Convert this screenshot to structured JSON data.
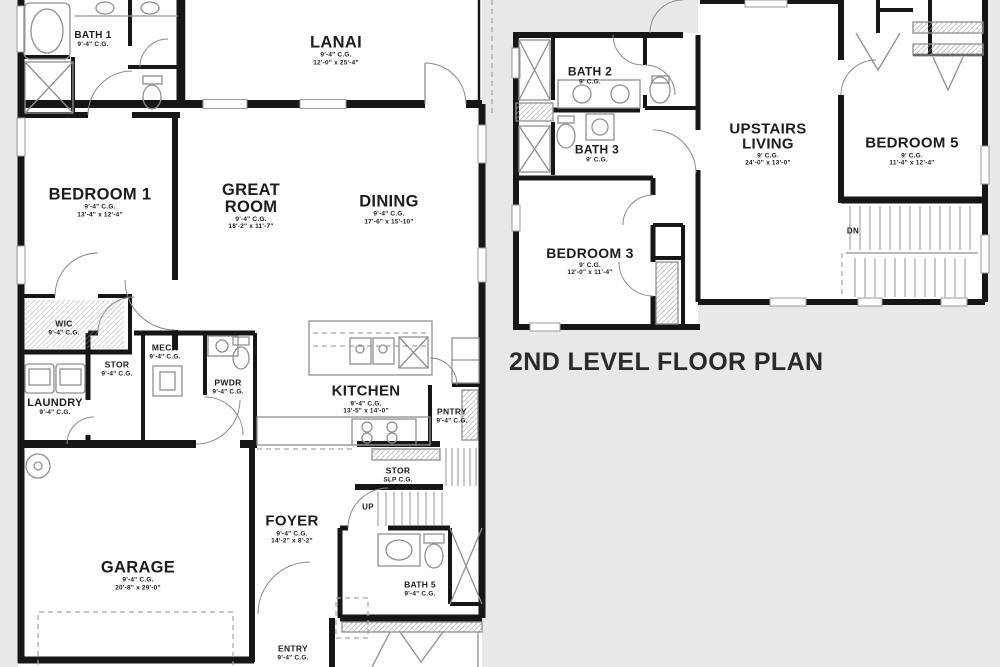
{
  "colors": {
    "background": "#e8e8e8",
    "plan": "#ffffff",
    "wall": "#161616",
    "fixture": "#8f8f8f",
    "text": "#1c1c1c"
  },
  "caption": "2ND LEVEL FLOOR PLAN",
  "first_level": {
    "rooms": {
      "bath_1": {
        "name": "BATH 1",
        "ceiling": "9'-4\" C.G."
      },
      "lanai": {
        "name": "LANAI",
        "ceiling": "9'-4\" C.G.",
        "dims": "12'-0\" x 25'-4\""
      },
      "bedroom_1": {
        "name": "BEDROOM 1",
        "ceiling": "9'-4\" C.G.",
        "dims": "13'-4\" x 12'-4\""
      },
      "great_room": {
        "name": "GREAT ROOM",
        "ceiling": "9'-4\" C.G.",
        "dims": "18'-2\" x 11'-7\""
      },
      "dining": {
        "name": "DINING",
        "ceiling": "9'-4\" C.G.",
        "dims": "17'-6\" x 15'-10\""
      },
      "wic": {
        "name": "WIC",
        "ceiling": "9'-4\" C.G."
      },
      "stor": {
        "name": "STOR",
        "ceiling": "9'-4\" C.G."
      },
      "mech": {
        "name": "MECH",
        "ceiling": "9'-4\" C.G."
      },
      "pwdr": {
        "name": "PWDR",
        "ceiling": "9'-4\" C.G."
      },
      "laundry": {
        "name": "LAUNDRY",
        "ceiling": "9'-4\" C.G."
      },
      "kitchen": {
        "name": "KITCHEN",
        "ceiling": "9'-4\" C.G.",
        "dims": "13'-5\" x 14'-0\""
      },
      "pntry": {
        "name": "PNTRY",
        "ceiling": "9'-4\" C.G."
      },
      "stor_stairs": {
        "name": "STOR",
        "ceiling": "SLP C.G."
      },
      "stairs_up": {
        "name": "UP"
      },
      "foyer": {
        "name": "FOYER",
        "ceiling": "9'-4\" C.G.",
        "dims": "14'-2\" x 8'-2\""
      },
      "garage": {
        "name": "GARAGE",
        "ceiling": "9'-4\" C.G.",
        "dims": "20'-8\" x 29'-0\""
      },
      "bath_5": {
        "name": "BATH 5",
        "ceiling": "9'-4\" C.G."
      },
      "entry": {
        "name": "ENTRY",
        "ceiling": "9'-4\" C.G."
      }
    }
  },
  "second_level": {
    "rooms": {
      "bath_2": {
        "name": "BATH 2",
        "ceiling": "9' C.G."
      },
      "bath_3": {
        "name": "BATH 3",
        "ceiling": "9' C.G."
      },
      "bedroom_3": {
        "name": "BEDROOM 3",
        "ceiling": "9' C.G.",
        "dims": "12'-0\" x 11'-4\""
      },
      "upstairs_living": {
        "name": "UPSTAIRS LIVING",
        "ceiling": "9' C.G.",
        "dims": "24'-0\" x 13'-0\""
      },
      "bedroom_5": {
        "name": "BEDROOM 5",
        "ceiling": "9' C.G.",
        "dims": "11'-4\" x 12'-4\""
      },
      "stairs_dn": {
        "name": "DN"
      }
    }
  }
}
